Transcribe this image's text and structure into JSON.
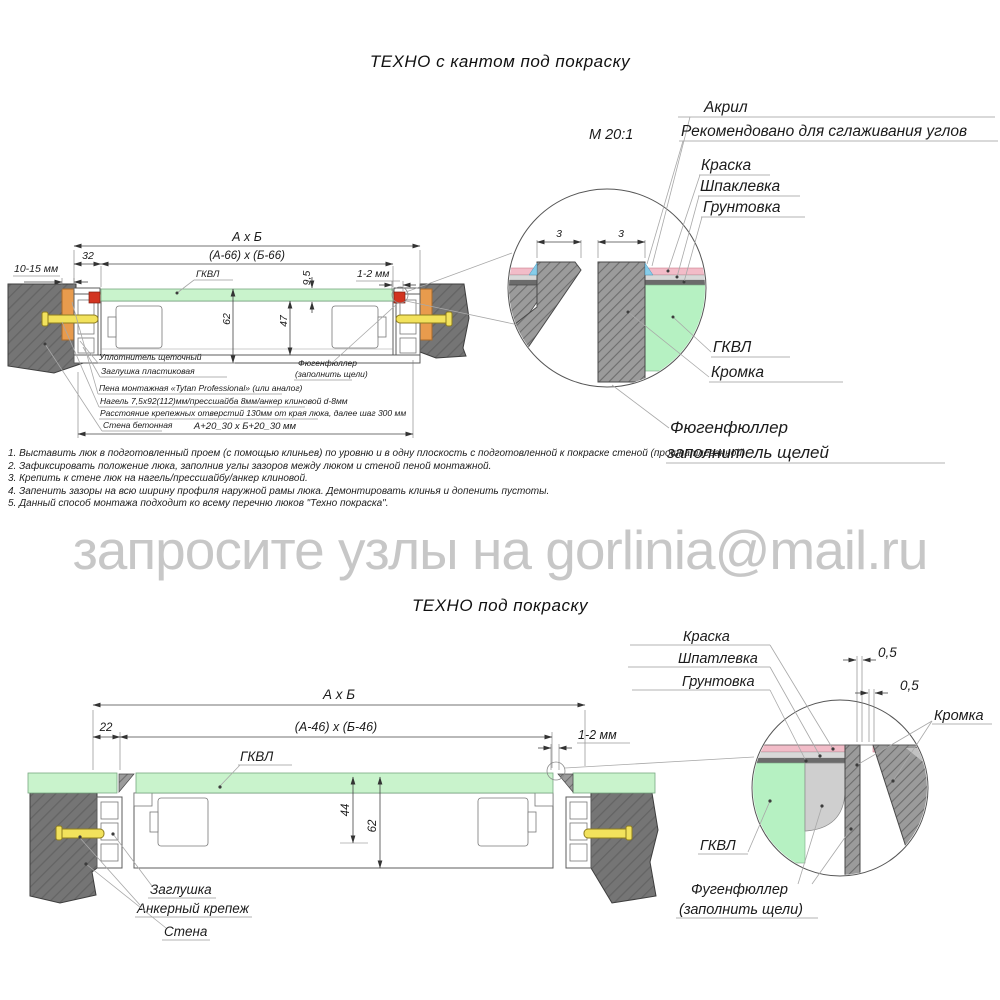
{
  "watermark": "запросите узлы на gorlinia@mail.ru",
  "top": {
    "title": "ТЕХНО с кантом под покраску",
    "scale": "М 20:1",
    "dims": {
      "overall": "А х Б",
      "inner": "(А-66) х (Б-66)",
      "flange": "32",
      "wall_gap": "10-15 мм",
      "panel_thickness": "9,5",
      "edge_gap": "1-2 мм",
      "height": "62",
      "inner_height": "47",
      "opening": "А+20_30 х Б+20_30 мм",
      "gkvl": "ГКВЛ",
      "gap_left": "3",
      "gap_right": "3"
    },
    "parts": {
      "seal": "Уплотнитель щеточный",
      "plug": "Заглушка пластиковая",
      "foam": "Пена монтажная «Tytan Professional» (или аналог)",
      "fastener": "Нагель 7,5х92(112)мм/прессшайба 8мм/анкер клиновой d-8мм",
      "spacing": "Расстояние крепежных отверстий 130мм от края люка, далее шаг 300 мм",
      "wall": "Стена бетонная",
      "filler_line1": "Фюгенфюллер",
      "filler_line2": "(заполнить щели)"
    },
    "callouts": {
      "acryl": "Акрил",
      "acryl_note": "Рекомендовано для сглаживания углов",
      "paint": "Краска",
      "putty": "Шпаклевка",
      "primer": "Грунтовка",
      "gkvl": "ГКВЛ",
      "edge": "Кромка",
      "filler_line1": "Фюгенфюллер",
      "filler_line2": "заполнитель щелей"
    }
  },
  "notes": [
    "1. Выставить люк в подготовленный проем (с помощью клиньев) по уровню и в одну плоскость с подготовленной к покраске стеной (прошпатлеванной).",
    "2. Зафиксировать положение люка, заполнив углы зазоров между люком и стеной пеной монтажной.",
    "3. Крепить к стене люк на нагель/прессшайбу/анкер клиновой.",
    "4. Запенить зазоры на всю ширину профиля наружной рамы люка. Демонтировать клинья и допенить пустоты.",
    "5. Данный способ монтажа подходит ко всему перечню люков \"Техно покраска\"."
  ],
  "bottom": {
    "title": "ТЕХНО под покраску",
    "dims": {
      "overall": "А х Б",
      "inner": "(А-46) х (Б-46)",
      "flange": "22",
      "edge_gap": "1-2 мм",
      "depth": "44",
      "height": "62",
      "gap1": "0,5",
      "gap2": "0,5",
      "gkvl": "ГКВЛ"
    },
    "parts": {
      "plug": "Заглушка",
      "anchor": "Анкерный крепеж",
      "wall": "Стена"
    },
    "callouts": {
      "paint": "Краска",
      "putty": "Шпатлевка",
      "primer": "Грунтовка",
      "edge": "Кромка",
      "gkvl": "ГКВЛ",
      "filler_line1": "Фугенфюллер",
      "filler_line2": "(заполнить щели)"
    }
  },
  "colors": {
    "wall": "#757575",
    "gkvl_green": "#c9f3cc",
    "detail_green": "#b6f1c2",
    "wedge_orange": "#e89b4d",
    "anchor_yellow": "#f2e25c",
    "gasket_red": "#d23420",
    "paint_pink": "#f2bcc8",
    "acryl_blue": "#86cdea",
    "watermark_gray": "#c7c7c7"
  }
}
